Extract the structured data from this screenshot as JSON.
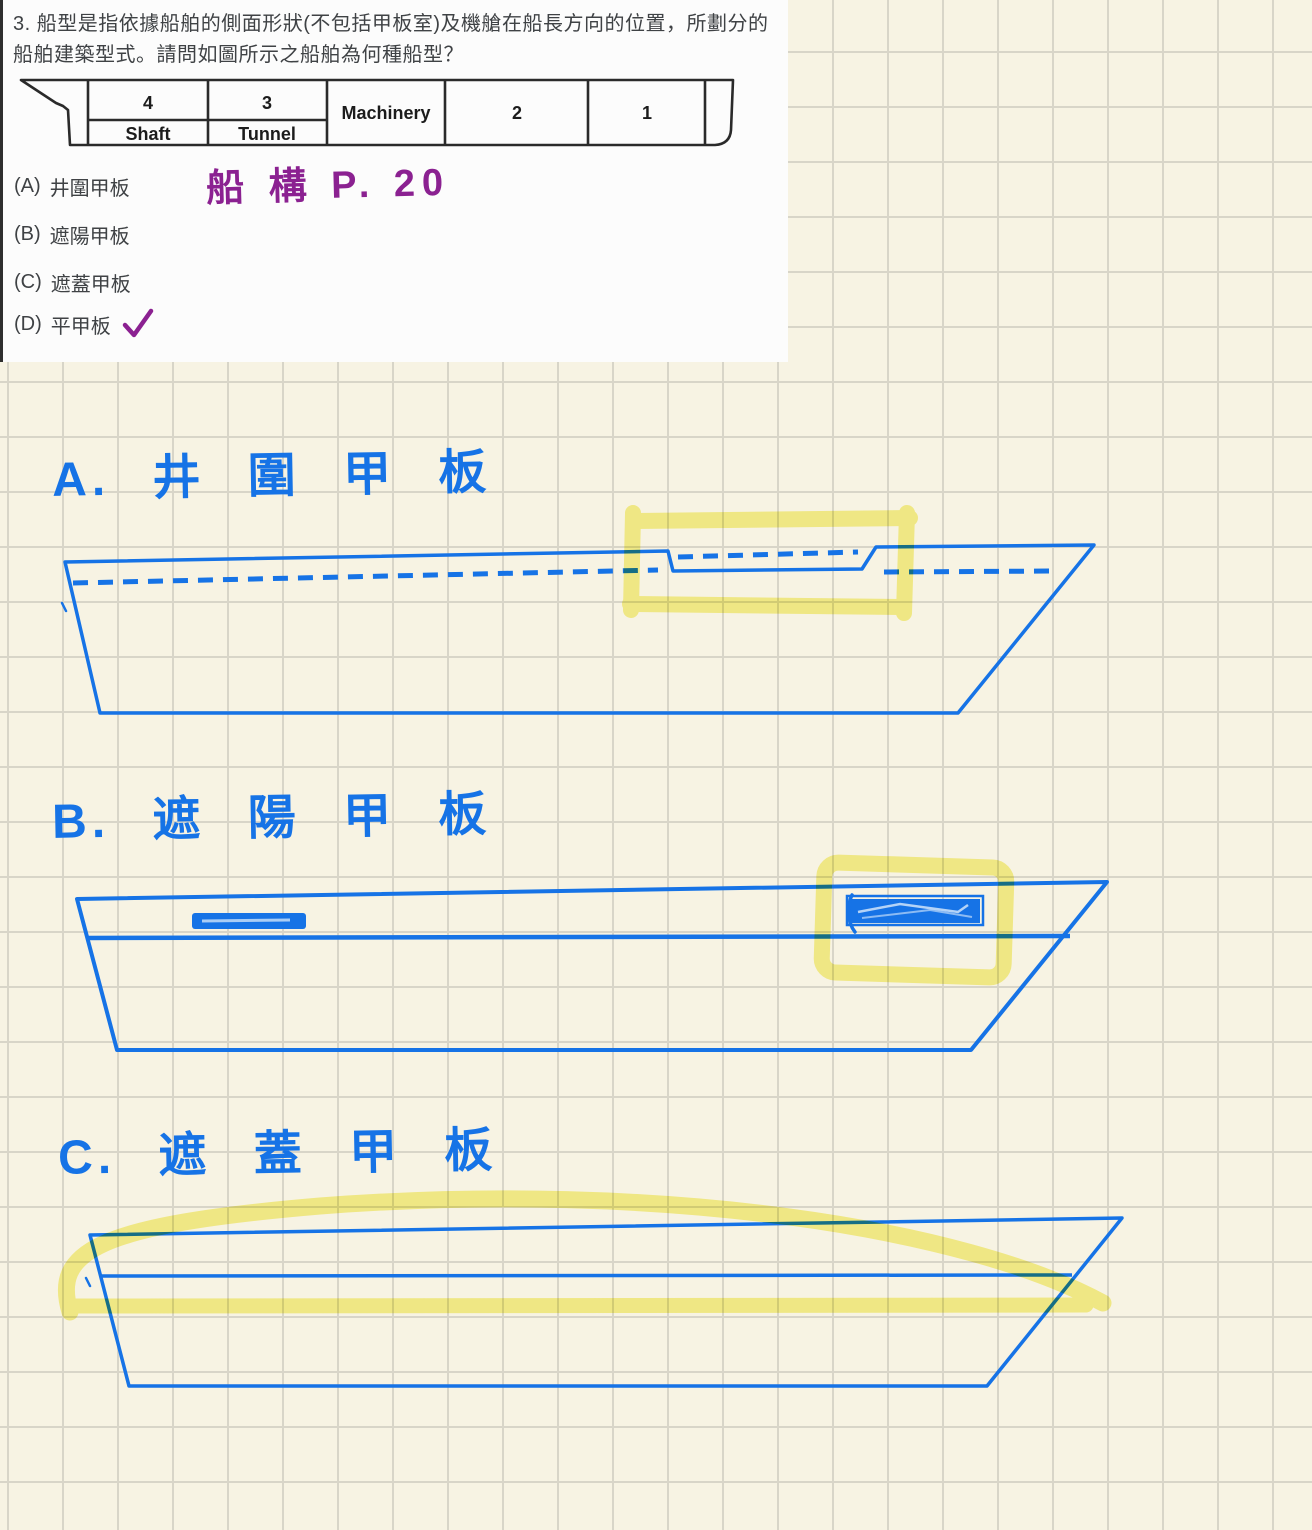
{
  "question": {
    "text": "3. 船型是指依據船舶的側面形狀(不包括甲板室)及機艙在船長方向的位置，所劃分的船舶建築型式。請問如圖所示之船舶為何種船型？",
    "figure": {
      "compartment_labels": {
        "c4": "4",
        "c3": "3",
        "machinery": "Machinery",
        "c2": "2",
        "c1": "1",
        "shaft": "Shaft",
        "tunnel": "Tunnel"
      }
    },
    "options": [
      {
        "key": "(A)",
        "label": "井圍甲板"
      },
      {
        "key": "(B)",
        "label": "遮陽甲板"
      },
      {
        "key": "(C)",
        "label": "遮蓋甲板"
      },
      {
        "key": "(D)",
        "label": "平甲板"
      }
    ],
    "selected_option": "(D)"
  },
  "annotations": {
    "reference_note": "船 構 P. 20",
    "checkmark": "✓"
  },
  "sections": [
    {
      "letter": "A",
      "title": "A. 井 圍 甲 板"
    },
    {
      "letter": "B",
      "title": "B. 遮 陽 甲 板"
    },
    {
      "letter": "C",
      "title": "C. 遮 蓋 甲 板"
    }
  ],
  "colors": {
    "pen_blue": "#1673e6",
    "highlighter_yellow": "#f1e93b",
    "pen_purple": "#8b2191",
    "paper_cream": "#f7f3e3",
    "grid_line": "#d8d5c8",
    "panel_white": "#fcfcfc",
    "figure_ink": "#2a2a2a",
    "text_dark": "#3f4245"
  }
}
